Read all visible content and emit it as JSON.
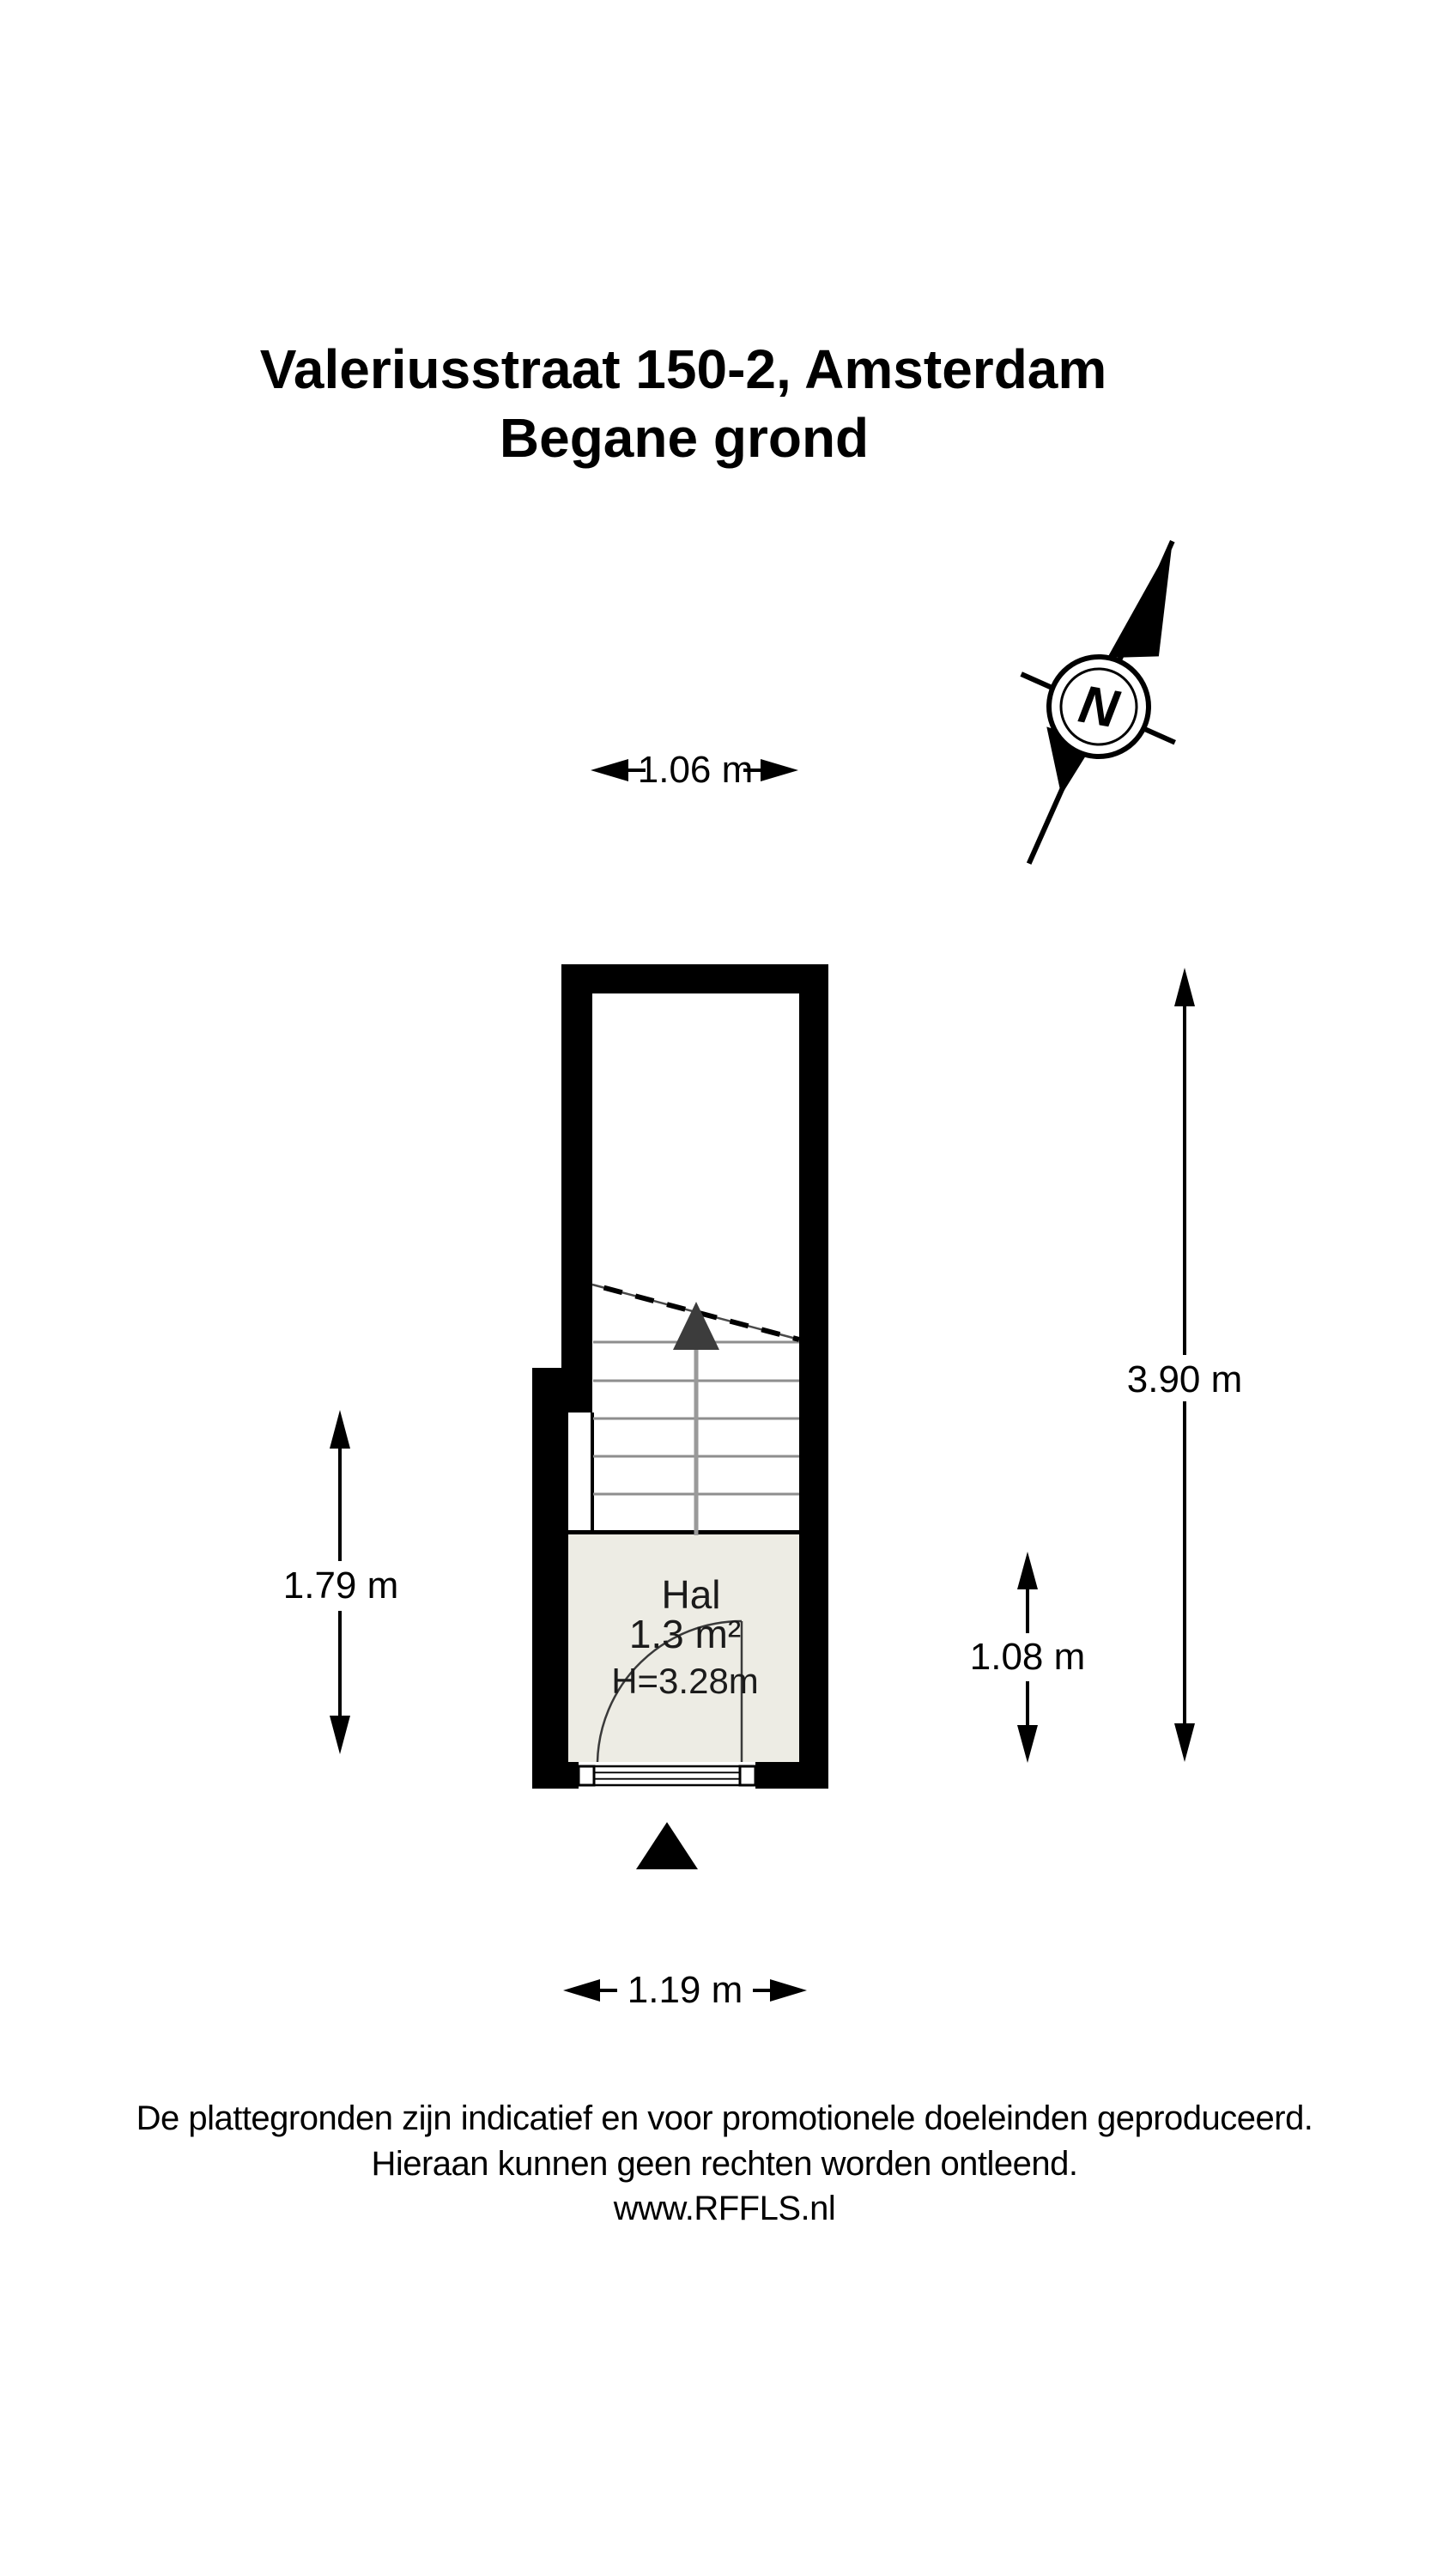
{
  "title": {
    "line1": "Valeriusstraat 150-2, Amsterdam",
    "line2": "Begane grond"
  },
  "compass": {
    "label": "N"
  },
  "dimensions": {
    "top_width": "1.06 m",
    "right_height": "3.90 m",
    "left_height": "1.79 m",
    "hall_height": "1.08 m",
    "bottom_width": "1.19 m"
  },
  "room": {
    "name": "Hal",
    "area": "1.3 m²",
    "ceiling_height": "H=3.28m"
  },
  "footer": {
    "line1": "De plattegronden zijn indicatief en voor promotionele doeleinden geproduceerd.",
    "line2": "Hieraan kunnen geen rechten worden ontleend.",
    "line3": "www.RFFLS.nl"
  },
  "colors": {
    "wall": "#000000",
    "room_fill": "#edece4",
    "stair_tread": "#8e8e8e",
    "stair_arrow_stem": "#9a9a9a",
    "stair_arrow_head": "#3c3c3c",
    "text": "#000000"
  }
}
